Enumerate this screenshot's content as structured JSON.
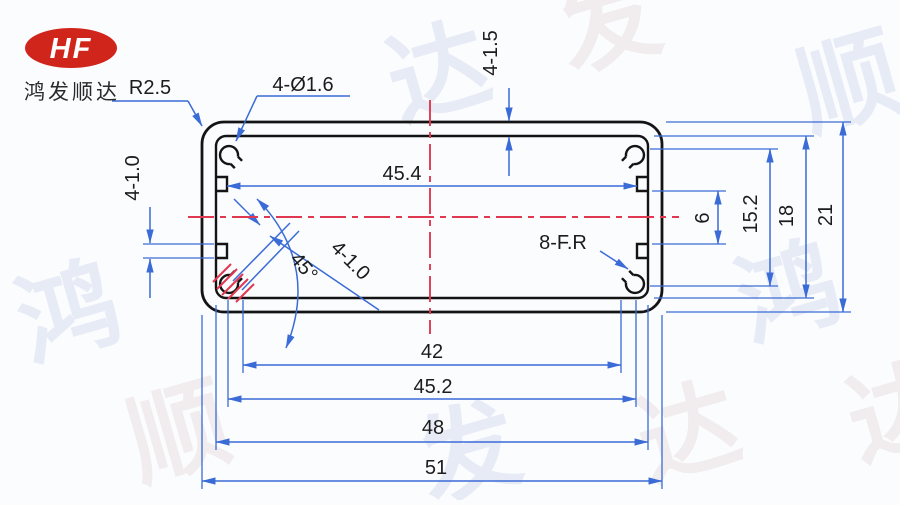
{
  "logo": {
    "brand": "HF",
    "company": "鸿发顺达",
    "oval_color": "#d0251b"
  },
  "drawing": {
    "type": "aluminum-extrusion-profile-cross-section",
    "labels": {
      "corner_radius": "R2.5",
      "holes": "4-Ø1.6",
      "wall_thickness": "4-1.5",
      "groove_left": "4-1.0",
      "slot_diagonal": "4-1.0",
      "angle": "45°",
      "fillets": "8-F.R"
    },
    "dimensions_horizontal": {
      "inner_notch_width": "45.4",
      "boss_span": "42",
      "lower_notch_span": "45.2",
      "inner_width": "48",
      "outer_width": "51"
    },
    "dimensions_vertical": {
      "guide_gap": "6",
      "boss_gap": "15.2",
      "inner_height": "18",
      "outer_height": "21"
    }
  },
  "colors": {
    "dimension_blue": "#3a6bd6",
    "centerline_red": "#e13852",
    "outline_black": "#141414",
    "watermark": "#dae1f1"
  },
  "watermark": {
    "chars": [
      "达",
      "顺",
      "发",
      "鸿",
      "达",
      "发",
      "顺",
      "鸿",
      "达"
    ]
  }
}
